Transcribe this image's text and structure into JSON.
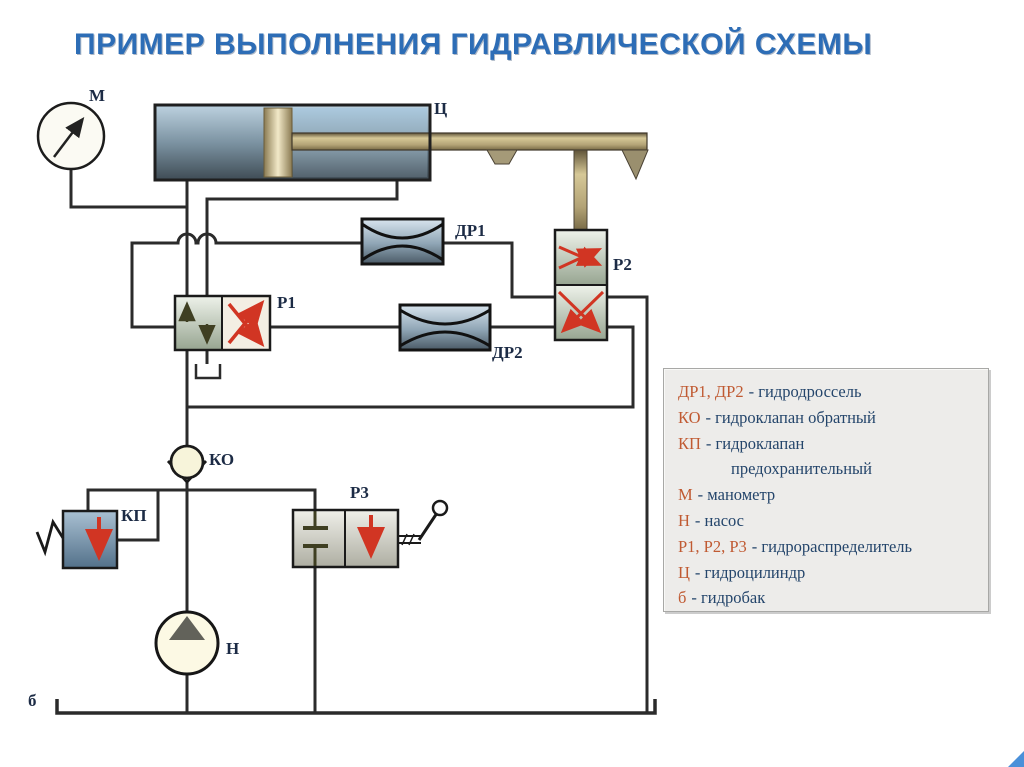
{
  "title": "ПРИМЕР ВЫПОЛНЕНИЯ ГИДРАВЛИЧЕСКОЙ СХЕМЫ",
  "labels": {
    "gauge": "М",
    "cylinder": "Ц",
    "throttle1": "ДР1",
    "throttle2": "ДР2",
    "valve1": "Р1",
    "valve2": "Р2",
    "valve3": "Р3",
    "check_valve": "КО",
    "relief_valve": "КП",
    "pump": "Н",
    "tank": "б"
  },
  "legend": {
    "entries": [
      {
        "key": "ДР1, ДР2",
        "text": "- гидродроссель"
      },
      {
        "key": "КО",
        "text": "- гидроклапан обратный"
      },
      {
        "key": "КП",
        "text": "- гидроклапан"
      },
      {
        "key": "",
        "text": "предохранительный"
      },
      {
        "key": "М",
        "text": "- манометр"
      },
      {
        "key": "Н",
        "text": "- насос"
      },
      {
        "key": "Р1, Р2, Р3",
        "text": "- гидрораспределитель"
      },
      {
        "key": "Ц",
        "text": "- гидроцилиндр"
      },
      {
        "key": "б",
        "text": "- гидробак"
      }
    ]
  },
  "colors": {
    "title_blue": "#2d6db6",
    "legend_key_orange": "#c05a32",
    "legend_text_navy": "#24456b",
    "pipe_dark": "#2b2b2b",
    "valve_arrow_red": "#d13523",
    "cylinder_blue": "#9fb9cc",
    "rod_tan": "#b3a376",
    "legend_bg": "#edecea"
  }
}
